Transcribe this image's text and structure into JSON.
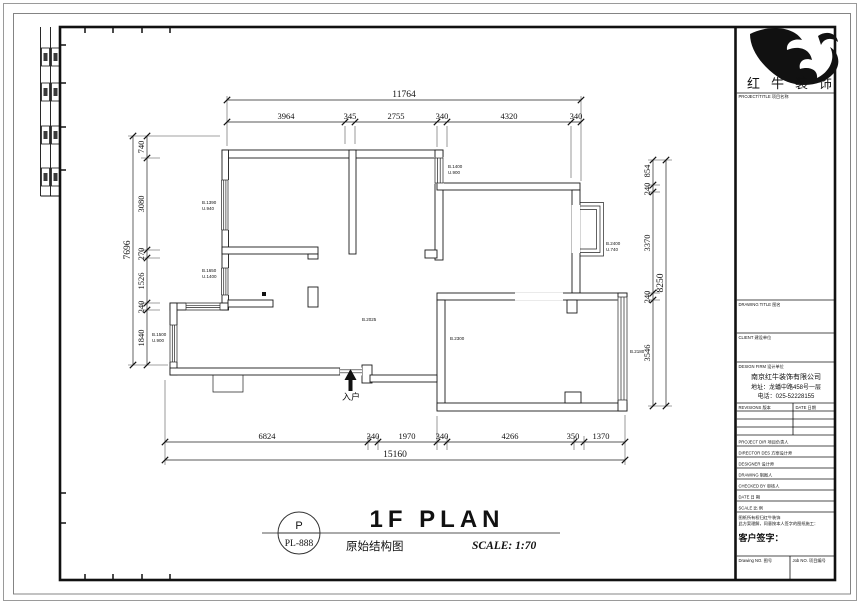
{
  "dims": {
    "top": {
      "overall": "11764",
      "segments": [
        "3964",
        "345",
        "2755",
        "340",
        "4320",
        "340"
      ]
    },
    "left": {
      "overall": "7696",
      "segments": [
        "740",
        "3080",
        "270",
        "1526",
        "240",
        "1840"
      ]
    },
    "right": {
      "overall": "8250",
      "segments": [
        "854",
        "240",
        "3370",
        "240",
        "3546"
      ]
    },
    "bottom": {
      "overall": "15160",
      "segments": [
        "6824",
        "340",
        "1970",
        "340",
        "4266",
        "350",
        "1370"
      ]
    }
  },
  "annotations": {
    "win_left_top": [
      "B.1390",
      "U.940"
    ],
    "win_left_mid": [
      "B.1650",
      "U.1400"
    ],
    "win_porch": [
      "B.1500",
      "U.900"
    ],
    "win_top_mid": [
      "B.1400",
      "U.900"
    ],
    "win_bay": [
      "B.2400",
      "U.740"
    ],
    "door_room": "B.2300",
    "win_room_right": "B.2180",
    "hall": "B.2025",
    "entry": "入户"
  },
  "title_bar": {
    "bubble_top": "P",
    "bubble_code": "PL-888",
    "plan_title": "1F PLAN",
    "plan_subtitle": "原始结构图",
    "scale_text": "SCALE: 1:70"
  },
  "title_block": {
    "company_logo_text": "红牛装饰",
    "project_title_label": "PROJECT/TITLE 项目名称",
    "drawing_title_label": "DRAWING TITLE 图名",
    "client_label": "CLIENT 建设单位",
    "design_firm_label": "DESIGN FIRM 设计单位",
    "company_name": "南京红牛装饰有限公司",
    "company_address": "地址：龙蟠中路458号一层",
    "company_phone": "电话：025-52228155",
    "revisions_label": "REVISIONS 版本",
    "date_col_label": "DATE 日期",
    "rows": [
      "PROJECT DIR 项目负责人",
      "DIRECTOR DES 方案设计师",
      "DESIGNER 设计师",
      "DRAWING 制图人",
      "CHECKED BY 审核人",
      "DATE 日 期",
      "SCALE 比 例"
    ],
    "note_line1": "图纸所有权归红牛装饰",
    "note_line2": "此方案理解，同意按本人签字的图纸施工：",
    "sign_label": "客户签字：",
    "drawing_no_label": "Drawing NO. 图号",
    "job_no_label": "Job NO. 项目编号"
  }
}
